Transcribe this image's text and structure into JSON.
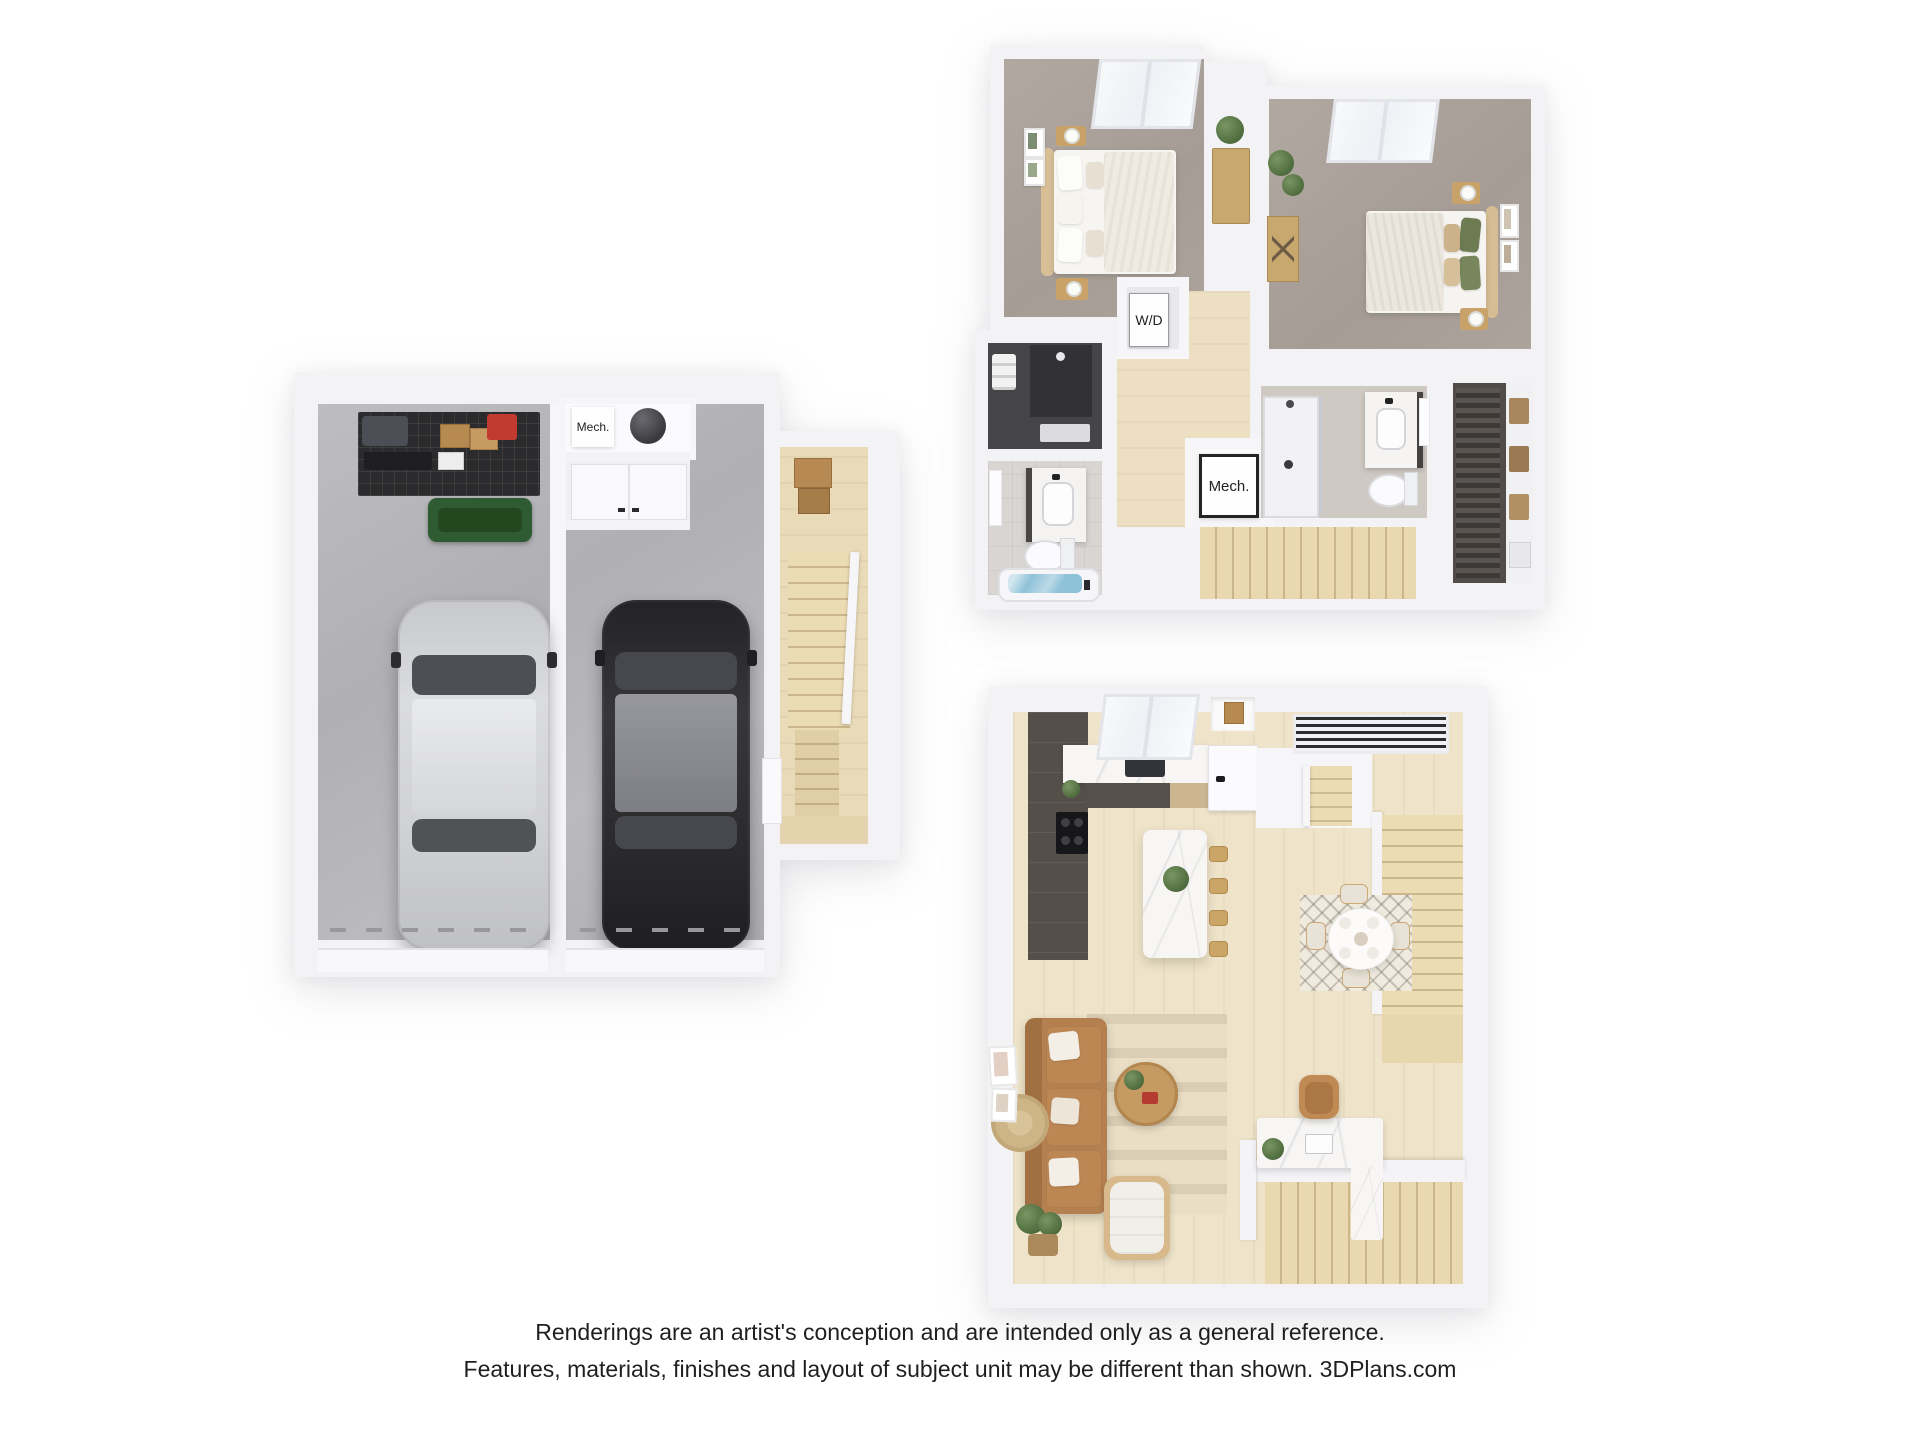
{
  "plans": {
    "garage": {
      "labels": {
        "mech": "Mech."
      }
    },
    "upper": {
      "labels": {
        "washer_dryer": "W/D",
        "mech": "Mech."
      }
    },
    "main": {
      "labels": {}
    }
  },
  "disclaimer": {
    "line1": "Renderings are an artist's conception and are intended only as a general reference.",
    "line2": "Features, materials, finishes and layout of subject unit may be different than shown. 3DPlans.com"
  },
  "colors": {
    "background": "#ffffff",
    "wall": "#f3f3f5",
    "concrete_floor": "#b4b4b8",
    "carpet": "#a9a19a",
    "wood_floor": "#efe4c9",
    "stair_wood": "#e7d6ae",
    "dark_cabinet": "#554f4a",
    "marble": "#f7f6f4",
    "sofa_leather": "#b5804f",
    "tub_water": "#8fc2d8",
    "car_dark": "#28282b",
    "car_silver": "#d3d4d7",
    "plant_green": "#4f6c3e",
    "label_text": "#222222",
    "disclaimer_text": "#1f1f1f"
  }
}
